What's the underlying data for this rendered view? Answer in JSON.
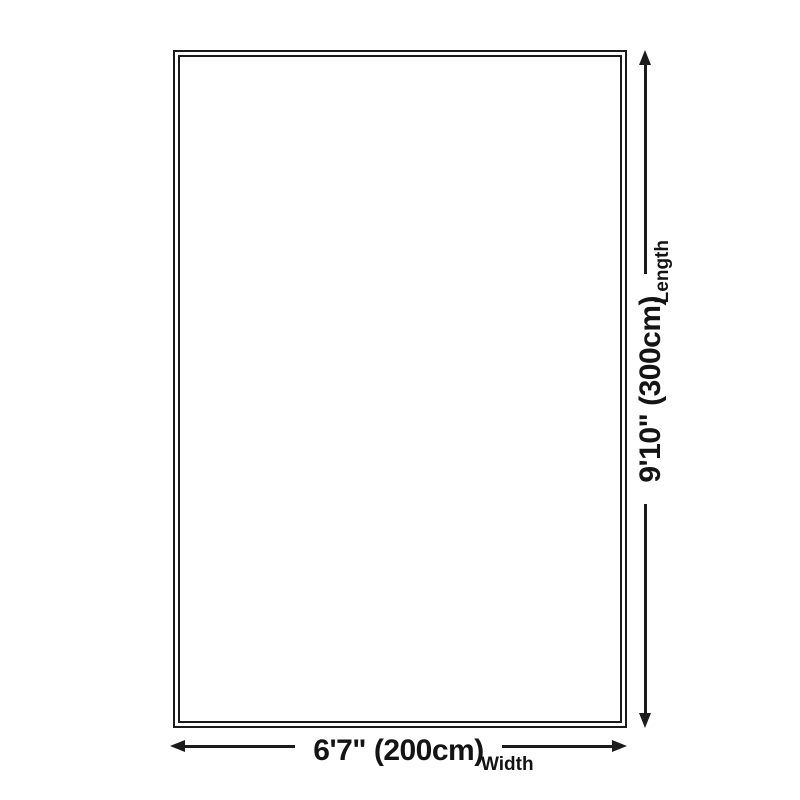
{
  "diagram": {
    "title": "rug-dimension-diagram",
    "length": {
      "value": "9'10\" (300cm)",
      "label": "Length",
      "orientation": "vertical"
    },
    "width": {
      "value": "6'7\" (200cm)",
      "label": "Width",
      "orientation": "horizontal"
    },
    "icons": [
      "arrow-up-icon",
      "arrow-down-icon",
      "arrow-left-icon",
      "arrow-right-icon"
    ],
    "colors": {
      "ink": "#1b1b1b",
      "text": "#141414",
      "background": "#ffffff"
    }
  }
}
